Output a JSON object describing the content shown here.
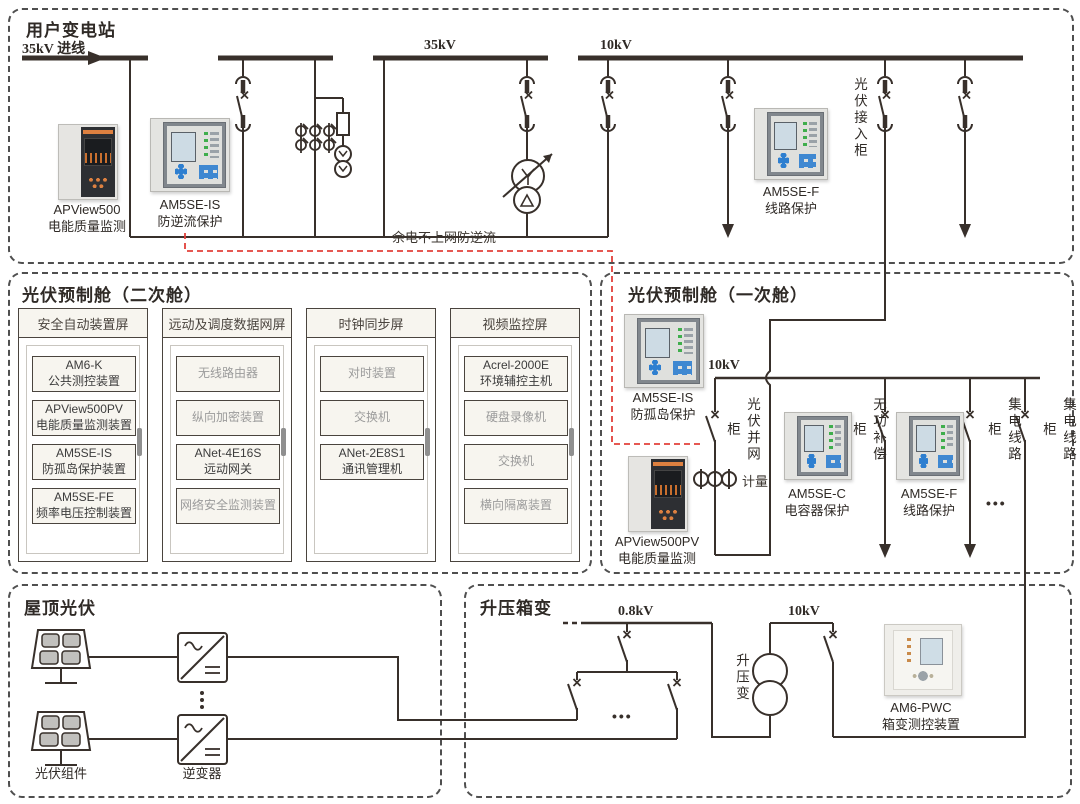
{
  "substation": {
    "title": "用户变电站",
    "incoming_label": "35kV 进线",
    "bus_35kv_label": "35kV",
    "bus_10kv_label": "10kV",
    "backflow_note": "余电不上网防逆流",
    "pv_inlet_cabinet": "光伏接入柜",
    "apview500": {
      "model": "APView500",
      "desc": "电能质量监测"
    },
    "am5se_is": {
      "model": "AM5SE-IS",
      "desc": "防逆流保护"
    },
    "am5se_f": {
      "model": "AM5SE-F",
      "desc": "线路保护"
    }
  },
  "secondary_cabin": {
    "title": "光伏预制舱（二次舱）",
    "cabinets": [
      {
        "header": "安全自动装置屏",
        "items": [
          {
            "line1": "AM6-K",
            "line2": "公共测控装置",
            "style": "accent"
          },
          {
            "line1": "APView500PV",
            "line2": "电能质量监测装置",
            "style": "accent"
          },
          {
            "line1": "AM5SE-IS",
            "line2": "防孤岛保护装置",
            "style": "accent"
          },
          {
            "line1": "AM5SE-FE",
            "line2": "频率电压控制装置",
            "style": "accent"
          }
        ]
      },
      {
        "header": "远动及调度数据网屏",
        "items": [
          {
            "line1": "无线路由器",
            "style": "muted"
          },
          {
            "line1": "纵向加密装置",
            "style": "muted"
          },
          {
            "line1": "ANet-4E16S",
            "line2": "远动网关",
            "style": "accent"
          },
          {
            "line1": "网络安全监测装置",
            "style": "muted"
          }
        ]
      },
      {
        "header": "时钟同步屏",
        "items": [
          {
            "line1": "对时装置",
            "style": "muted"
          },
          {
            "line1": "交换机",
            "style": "muted"
          },
          {
            "line1": "ANet-2E8S1",
            "line2": "通讯管理机",
            "style": "accent"
          }
        ]
      },
      {
        "header": "视频监控屏",
        "items": [
          {
            "line1": "Acrel-2000E",
            "line2": "环境辅控主机",
            "style": "accent"
          },
          {
            "line1": "硬盘录像机",
            "style": "muted"
          },
          {
            "line1": "交换机",
            "style": "muted"
          },
          {
            "line1": "横向隔离装置",
            "style": "muted"
          }
        ]
      }
    ]
  },
  "primary_cabin": {
    "title": "光伏预制舱（一次舱）",
    "bus_10kv_label": "10kV",
    "grid_tie_cabinet": "光伏并网柜",
    "metering_label": "计量",
    "reactive_comp_cabinet": "无功补偿柜",
    "collector_cabinet_1": "集电线路柜",
    "collector_cabinet_2": "集电线路柜",
    "ellipsis": "•••",
    "am5se_is": {
      "model": "AM5SE-IS",
      "desc": "防孤岛保护"
    },
    "apview500pv": {
      "model": "APView500PV",
      "desc": "电能质量监测"
    },
    "am5se_c": {
      "model": "AM5SE-C",
      "desc": "电容器保护"
    },
    "am5se_f": {
      "model": "AM5SE-F",
      "desc": "线路保护"
    }
  },
  "rooftop_pv": {
    "title": "屋顶光伏",
    "pv_module_label": "光伏组件",
    "inverter_label": "逆变器",
    "ellipsis": "⋮"
  },
  "boost_station": {
    "title": "升压箱变",
    "bus_08kv_label": "0.8kV",
    "bus_10kv_label": "10kV",
    "transformer_label": "升压变",
    "ellipsis": "•••",
    "am6_pwc": {
      "model": "AM6-PWC",
      "desc": "箱变测控装置"
    }
  }
}
